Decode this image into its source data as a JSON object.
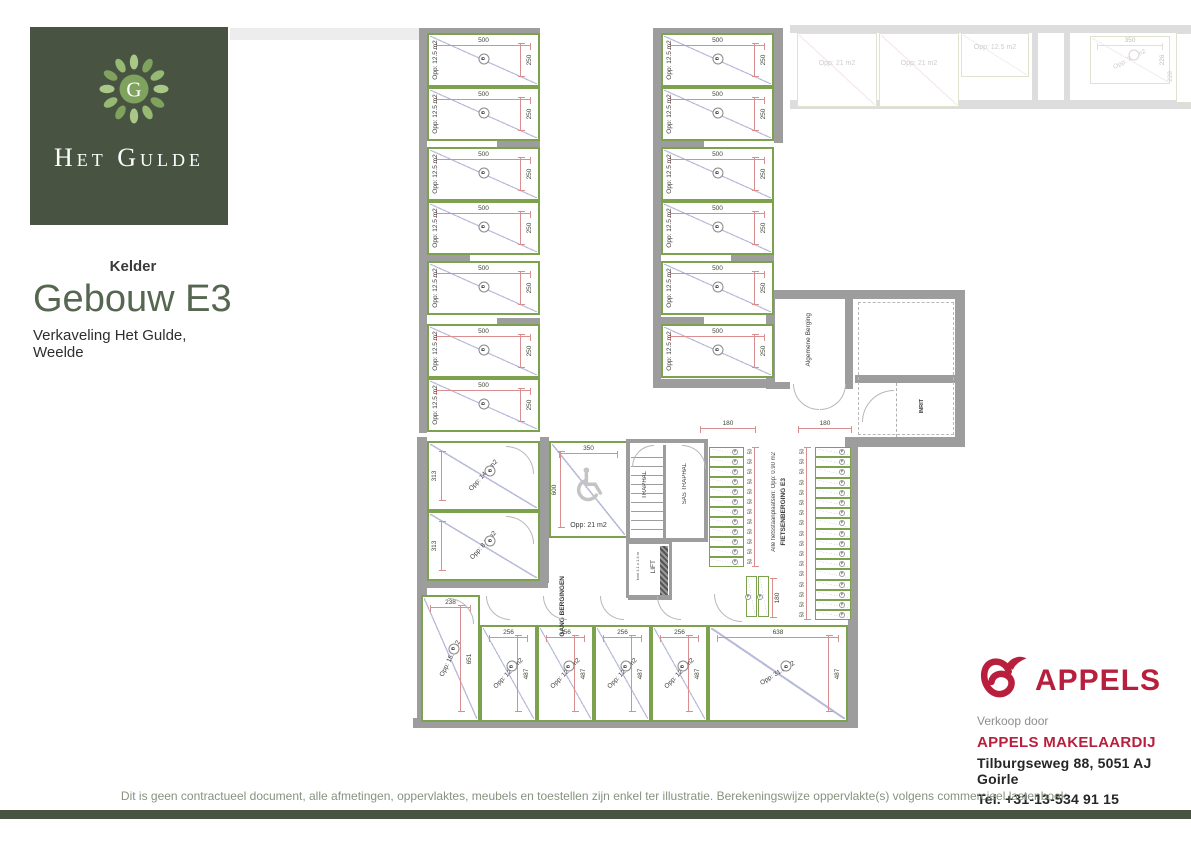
{
  "brand": {
    "logo_monogram": "G",
    "logo_text": "Het Gulde"
  },
  "title": {
    "floor": "Kelder",
    "building": "Gebouw E3",
    "subtitle": "Verkaveling Het Gulde, Weelde"
  },
  "plan": {
    "marker": "B",
    "bike_marker": "P",
    "storage_unit": {
      "area": "Opp: 12.5 m2",
      "width": "500",
      "depth": "250"
    },
    "col_a_count": 7,
    "col_b_count": 6,
    "rooms_left": [
      {
        "area": "Opp: 14.7 m2",
        "side": "313"
      },
      {
        "area": "Opp: 8.7 m2",
        "side": "313"
      }
    ],
    "bottom_units": [
      {
        "top": "238",
        "area": "Opp: 15.2 m2",
        "side": "651"
      },
      {
        "top": "256",
        "area": "Opp: 12.4 m2",
        "side": "487"
      },
      {
        "top": "256",
        "area": "Opp: 12.4 m2",
        "side": "487"
      },
      {
        "top": "256",
        "area": "Opp: 12.4 m2",
        "side": "487"
      },
      {
        "top": "256",
        "area": "Opp: 12.4 m2",
        "side": "487"
      },
      {
        "top": "638",
        "area": "Opp: 31.0 m2",
        "side": "487"
      }
    ],
    "disabled_spot": {
      "top": "350",
      "side": "600",
      "area": "Opp: 21 m2"
    },
    "stairs": {
      "traphal": "TRAPHAL",
      "sas": "SAS TRAPHAL"
    },
    "lift": {
      "label": "LIFT",
      "note": "kooi 1.1 x 1.4 m"
    },
    "gang": "GANG BERGINGEN",
    "algemene_berging": "Algemene Berging",
    "inrit": "INRIT",
    "bike": {
      "note": "Alle fietsstaanplaatsen: Opp: 0.90 m2",
      "name": "FIETSENBERGING E3",
      "left_slots": 12,
      "right_slots": 17
    },
    "dims": {
      "d180": "180",
      "d50": "50"
    },
    "faint_units": [
      {
        "area": "Opp: 21 m2"
      },
      {
        "area": "Opp: 21 m2"
      },
      {
        "area": "Opp: 12.5 m2"
      }
    ],
    "faint_right": {
      "top": "350",
      "area": "Opp: 7.9 m2",
      "side": "226",
      "side2": "228"
    }
  },
  "footer": {
    "disclaimer": "Dit is geen contractueel document, alle afmetingen, oppervlaktes, meubels en toestellen zijn enkel ter illustratie. Berekeningswijze oppervlakte(s) volgens commercieel lastenboek.",
    "agency": {
      "wordmark": "APPELS",
      "intro": "Verkoop door",
      "name": "APPELS MAKELAARDIJ",
      "address": "Tilburgseweg 88, 5051 AJ Goirle",
      "phone": "Tel. +31-13-534 91 15"
    }
  },
  "colors": {
    "brand_green": "#485441",
    "accent_green": "#7da24e",
    "appels_red": "#b81f3d",
    "wall_gray": "#9d9d9d",
    "dim_red": "#d98f8f",
    "diag_blue": "#b8bcda",
    "title_green": "#566751"
  }
}
